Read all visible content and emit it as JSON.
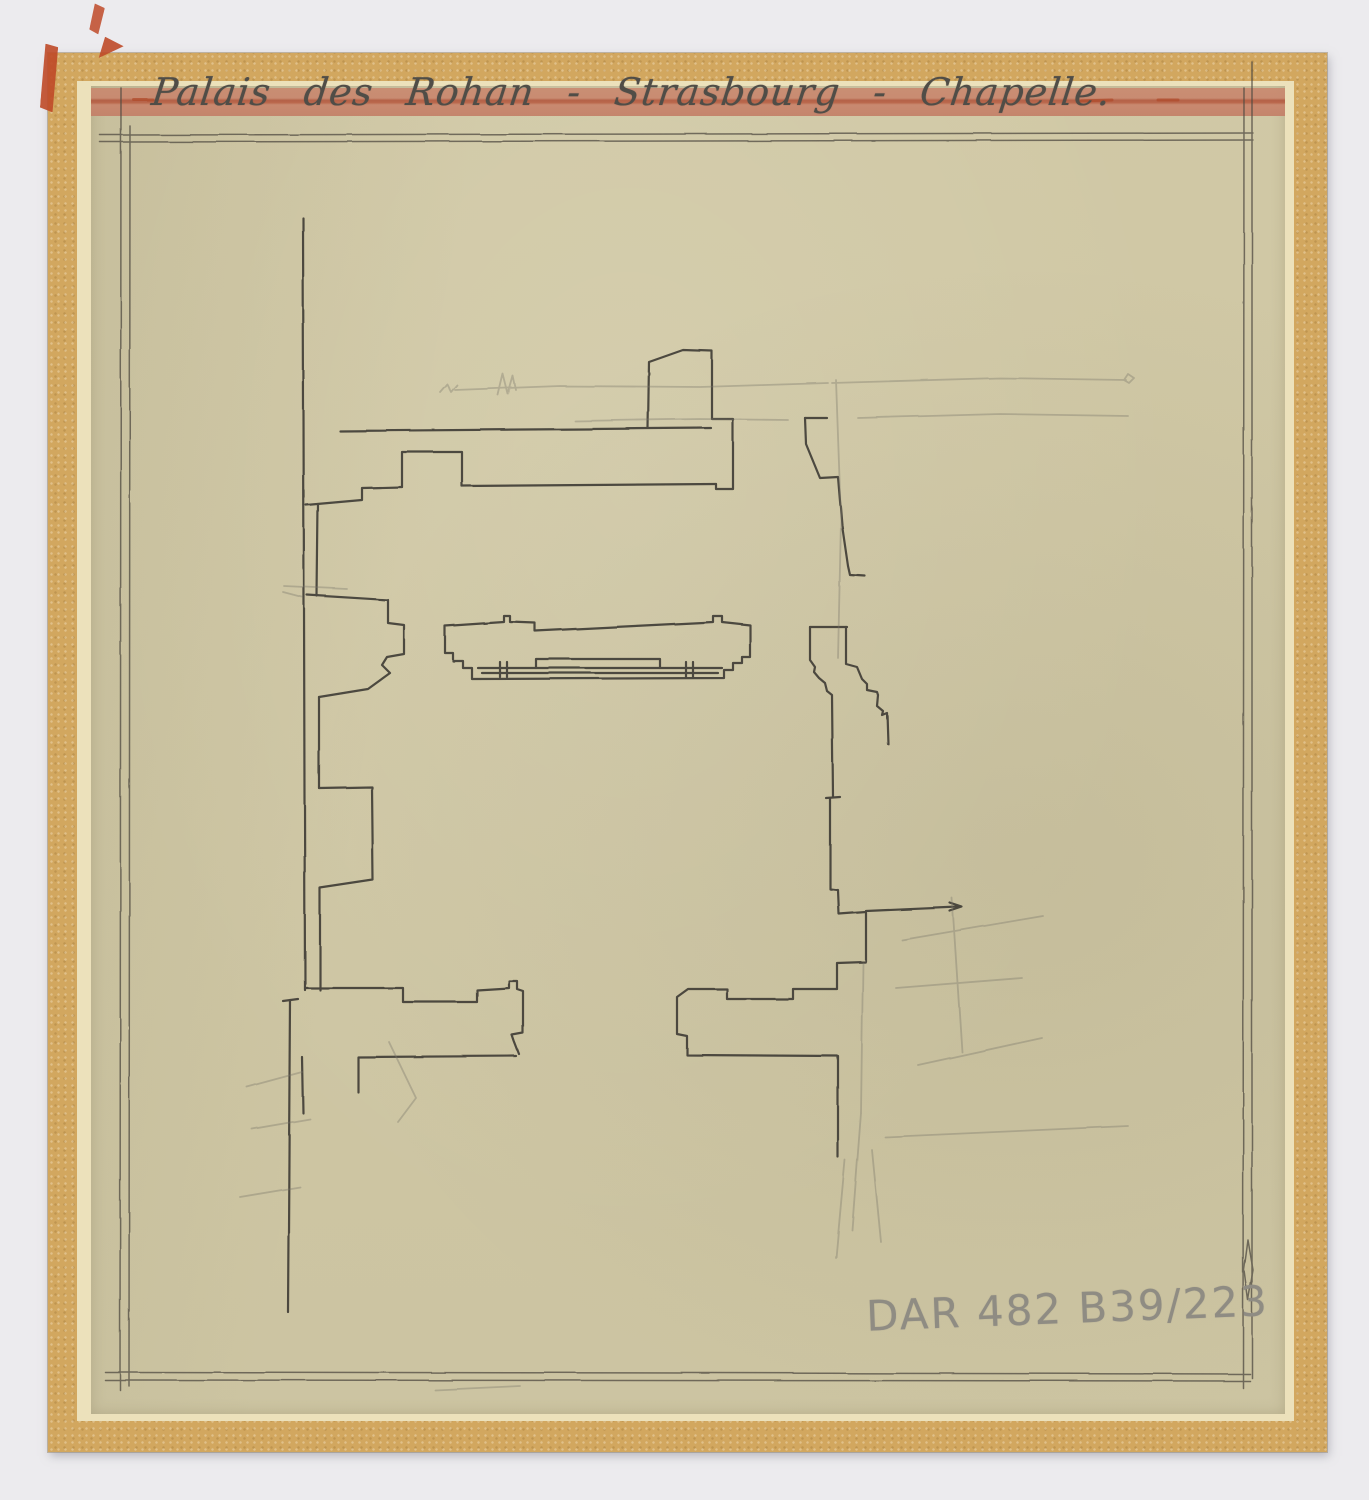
{
  "document": {
    "title_inscription": "Palais des Rohan - Strasbourg - Chapelle.",
    "reference_number": "DAR 482 B39/223"
  },
  "colors": {
    "scan_background": "#ecebee",
    "mount_tape": "#d2a75f",
    "mount_tape_edge": "#ece1bb",
    "tracing_paper": "#d7cfac",
    "red_band": "#c5836c",
    "red_tape": "#bf4a28",
    "pencil_dark": "#3d3a33",
    "pencil_faint": "#7b766a",
    "ruled_border": "#4f4b42",
    "graphite_label": "#8f8c83"
  },
  "drawing": {
    "groups": [
      {
        "name": "ruled-border",
        "color": "#4f4b42",
        "width": 1.5,
        "opacity": 0.75,
        "paths": [
          [
            [
              100,
              135
            ],
            [
              1253,
              133
            ]
          ],
          [
            [
              100,
              142
            ],
            [
              1253,
              140
            ]
          ],
          [
            [
              121,
              88
            ],
            [
              120,
              1390
            ]
          ],
          [
            [
              130,
              126
            ],
            [
              129,
              1386
            ]
          ],
          [
            [
              105,
              1372
            ],
            [
              1250,
              1374
            ]
          ],
          [
            [
              105,
              1380
            ],
            [
              1250,
              1381
            ]
          ],
          [
            [
              1244,
              88
            ],
            [
              1243,
              1388
            ]
          ],
          [
            [
              1252,
              62
            ],
            [
              1252,
              1378
            ]
          ],
          [
            [
              1248,
              1240
            ],
            [
              1253,
              1270
            ],
            [
              1248,
              1300
            ],
            [
              1244,
              1270
            ],
            [
              1248,
              1240
            ]
          ]
        ]
      },
      {
        "name": "sketch-dark",
        "color": "#3d3a33",
        "width": 2.2,
        "opacity": 0.9,
        "paths": [
          [
            [
              303,
              218
            ],
            [
              305,
              990
            ]
          ],
          [
            [
              340,
              431
            ],
            [
              711,
              428
            ]
          ],
          [
            [
              648,
              428
            ],
            [
              649,
              362
            ],
            [
              683,
              350
            ],
            [
              712,
              351
            ],
            [
              712,
              419
            ],
            [
              733,
              419
            ],
            [
              733,
              489
            ],
            [
              716,
              489
            ],
            [
              716,
              484
            ]
          ],
          [
            [
              716,
              484
            ],
            [
              462,
              486
            ]
          ],
          [
            [
              462,
              486
            ],
            [
              462,
              452
            ],
            [
              402,
              452
            ],
            [
              402,
              487
            ]
          ],
          [
            [
              402,
              487
            ],
            [
              362,
              488
            ],
            [
              362,
              500
            ],
            [
              306,
              505
            ]
          ],
          [
            [
              318,
              504
            ],
            [
              317,
              596
            ]
          ],
          [
            [
              307,
              595
            ],
            [
              388,
              600
            ],
            [
              388,
              623
            ],
            [
              404,
              625
            ],
            [
              404,
              654
            ],
            [
              387,
              657
            ],
            [
              382,
              665
            ],
            [
              390,
              673
            ],
            [
              368,
              689
            ],
            [
              319,
              697
            ]
          ],
          [
            [
              319,
              697
            ],
            [
              319,
              788
            ]
          ],
          [
            [
              319,
              788
            ],
            [
              372,
              787
            ],
            [
              373,
              880
            ],
            [
              320,
              888
            ],
            [
              320,
              990
            ]
          ],
          [
            [
              305,
              988
            ],
            [
              403,
              988
            ],
            [
              403,
              1002
            ],
            [
              477,
              1002
            ],
            [
              477,
              990
            ],
            [
              509,
              988
            ],
            [
              509,
              981
            ],
            [
              517,
              981
            ],
            [
              517,
              989
            ],
            [
              523,
              991
            ],
            [
              523,
              1033
            ],
            [
              512,
              1035
            ],
            [
              514,
              1041
            ],
            [
              519,
              1054
            ]
          ],
          [
            [
              516,
              1056
            ],
            [
              358,
              1057
            ],
            [
              358,
              1092
            ]
          ],
          [
            [
              290,
              1000
            ],
            [
              288,
              1312
            ]
          ],
          [
            [
              283,
              1001
            ],
            [
              298,
              999
            ]
          ],
          [
            [
              302,
              1057
            ],
            [
              303,
              1113
            ]
          ],
          [
            [
              445,
              626
            ],
            [
              504,
              622
            ],
            [
              504,
              616
            ],
            [
              510,
              616
            ],
            [
              510,
              622
            ],
            [
              535,
              623
            ],
            [
              535,
              631
            ],
            [
              713,
              622
            ],
            [
              713,
              616
            ],
            [
              722,
              616
            ],
            [
              722,
              622
            ],
            [
              750,
              625
            ],
            [
              750,
              657
            ],
            [
              742,
              657
            ],
            [
              742,
              663
            ],
            [
              733,
              663
            ],
            [
              733,
              670
            ],
            [
              724,
              670
            ],
            [
              724,
              678
            ],
            [
              472,
              679
            ],
            [
              472,
              668
            ],
            [
              463,
              668
            ],
            [
              463,
              661
            ],
            [
              453,
              661
            ],
            [
              453,
              653
            ],
            [
              445,
              653
            ],
            [
              445,
              626
            ]
          ],
          [
            [
              536,
              668
            ],
            [
              536,
              659
            ],
            [
              660,
              659
            ],
            [
              660,
              668
            ]
          ],
          [
            [
              478,
              668
            ],
            [
              722,
              668
            ]
          ],
          [
            [
              482,
              673
            ],
            [
              718,
              673
            ]
          ],
          [
            [
              500,
              662
            ],
            [
              500,
              677
            ]
          ],
          [
            [
              507,
              662
            ],
            [
              507,
              677
            ]
          ],
          [
            [
              686,
              662
            ],
            [
              686,
              677
            ]
          ],
          [
            [
              693,
              662
            ],
            [
              693,
              677
            ]
          ],
          [
            [
              805,
              418
            ],
            [
              827,
              418
            ]
          ],
          [
            [
              805,
              418
            ],
            [
              806,
              444
            ],
            [
              820,
              478
            ],
            [
              838,
              477
            ],
            [
              842,
              525
            ],
            [
              848,
              566
            ],
            [
              850,
              575
            ],
            [
              865,
              576
            ]
          ],
          [
            [
              810,
              627
            ],
            [
              847,
              627
            ]
          ],
          [
            [
              810,
              627
            ],
            [
              810,
              660
            ],
            [
              815,
              667
            ],
            [
              814,
              672
            ],
            [
              819,
              678
            ],
            [
              825,
              683
            ],
            [
              827,
              691
            ],
            [
              832,
              695
            ],
            [
              833,
              797
            ]
          ],
          [
            [
              826,
              798
            ],
            [
              840,
              797
            ]
          ],
          [
            [
              846,
              627
            ],
            [
              846,
              664
            ],
            [
              857,
              667
            ],
            [
              862,
              679
            ],
            [
              867,
              684
            ],
            [
              867,
              690
            ],
            [
              877,
              692
            ],
            [
              878,
              695
            ],
            [
              877,
              706
            ],
            [
              883,
              711
            ],
            [
              882,
              715
            ],
            [
              887,
              713
            ],
            [
              888,
              744
            ]
          ],
          [
            [
              830,
              798
            ],
            [
              830,
              889
            ],
            [
              838,
              890
            ],
            [
              839,
              914
            ],
            [
              866,
              912
            ]
          ],
          [
            [
              866,
              911
            ],
            [
              958,
              907
            ]
          ],
          [
            [
              950,
              903
            ],
            [
              962,
              907
            ],
            [
              950,
              911
            ]
          ],
          [
            [
              866,
              913
            ],
            [
              866,
              962
            ],
            [
              837,
              963
            ],
            [
              837,
              989
            ],
            [
              793,
              989
            ],
            [
              793,
              999
            ],
            [
              727,
              999
            ],
            [
              727,
              989
            ],
            [
              688,
              989
            ],
            [
              677,
              997
            ],
            [
              677,
              1034
            ],
            [
              687,
              1036
            ],
            [
              687,
              1055
            ],
            [
              838,
              1056
            ],
            [
              838,
              1157
            ]
          ]
        ]
      },
      {
        "name": "sketch-faint",
        "color": "#7b766a",
        "width": 1.8,
        "opacity": 0.38,
        "paths": [
          [
            [
              455,
              390
            ],
            [
              560,
              386
            ],
            [
              700,
              387
            ],
            [
              828,
              383
            ]
          ],
          [
            [
              832,
              383
            ],
            [
              1000,
              378
            ],
            [
              1126,
              380
            ]
          ],
          [
            [
              1124,
              380
            ],
            [
              1128,
              374
            ],
            [
              1134,
              378
            ],
            [
              1129,
              383
            ],
            [
              1124,
              380
            ]
          ],
          [
            [
              575,
              421
            ],
            [
              700,
              419
            ],
            [
              788,
              420
            ]
          ],
          [
            [
              858,
              418
            ],
            [
              1000,
              414
            ],
            [
              1128,
              416
            ]
          ],
          [
            [
              440,
              392
            ],
            [
              447,
              384
            ],
            [
              451,
              392
            ],
            [
              457,
              385
            ]
          ],
          [
            [
              498,
              395
            ],
            [
              503,
              374
            ],
            [
              508,
              394
            ],
            [
              513,
              376
            ],
            [
              516,
              390
            ]
          ],
          [
            [
              284,
              586
            ],
            [
              347,
              589
            ]
          ],
          [
            [
              283,
              592
            ],
            [
              302,
              597
            ]
          ],
          [
            [
              836,
              380
            ],
            [
              841,
              520
            ],
            [
              838,
              658
            ]
          ],
          [
            [
              902,
              940
            ],
            [
              1043,
              916
            ]
          ],
          [
            [
              896,
              988
            ],
            [
              1022,
              978
            ]
          ],
          [
            [
              918,
              1065
            ],
            [
              1042,
              1038
            ]
          ],
          [
            [
              952,
              898
            ],
            [
              962,
              1052
            ]
          ],
          [
            [
              885,
              1137
            ],
            [
              1128,
              1126
            ]
          ],
          [
            [
              863,
              963
            ],
            [
              861,
              1113
            ]
          ],
          [
            [
              861,
              1113
            ],
            [
              852,
              1230
            ]
          ],
          [
            [
              845,
              1160
            ],
            [
              836,
              1258
            ]
          ],
          [
            [
              872,
              1150
            ],
            [
              881,
              1242
            ]
          ],
          [
            [
              247,
              1087
            ],
            [
              302,
              1072
            ]
          ],
          [
            [
              252,
              1129
            ],
            [
              310,
              1119
            ]
          ],
          [
            [
              240,
              1197
            ],
            [
              300,
              1187
            ]
          ],
          [
            [
              389,
              1042
            ],
            [
              416,
              1098
            ],
            [
              398,
              1122
            ]
          ],
          [
            [
              435,
              1390
            ],
            [
              520,
              1386
            ]
          ]
        ]
      },
      {
        "name": "red-marks",
        "color": "#b04a2c",
        "width": 3,
        "opacity": 0.7,
        "paths": [
          [
            [
              133,
              99
            ],
            [
              152,
              99
            ]
          ],
          [
            [
              1080,
              101
            ],
            [
              1112,
              100
            ]
          ],
          [
            [
              1158,
              100
            ],
            [
              1178,
              100
            ]
          ]
        ]
      }
    ]
  }
}
